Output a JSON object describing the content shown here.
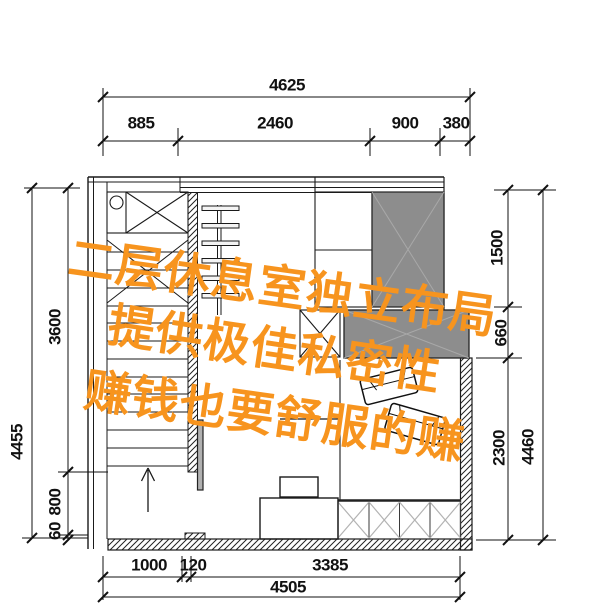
{
  "watermark": {
    "color": "#F7941E",
    "lines": [
      "二层休息室独立布局",
      "提供极佳私密性",
      "赚钱也要舒服的赚"
    ]
  },
  "dimensions": {
    "top": {
      "total": "4625",
      "segments": [
        "885",
        "2460",
        "900",
        "380"
      ]
    },
    "bottom": {
      "total": "4505",
      "segments": [
        "1000",
        "120",
        "3385"
      ]
    },
    "left": {
      "total": "4455",
      "segments": [
        "3600",
        "800",
        "60"
      ]
    },
    "right": {
      "total": "4460",
      "segments": [
        "1500",
        "660",
        "2300"
      ]
    }
  },
  "plan_colors": {
    "wardrobe_gray": "#8d8d8d",
    "line_black": "#1a1a1a",
    "storage_x_gray": "#b3b3b3"
  }
}
